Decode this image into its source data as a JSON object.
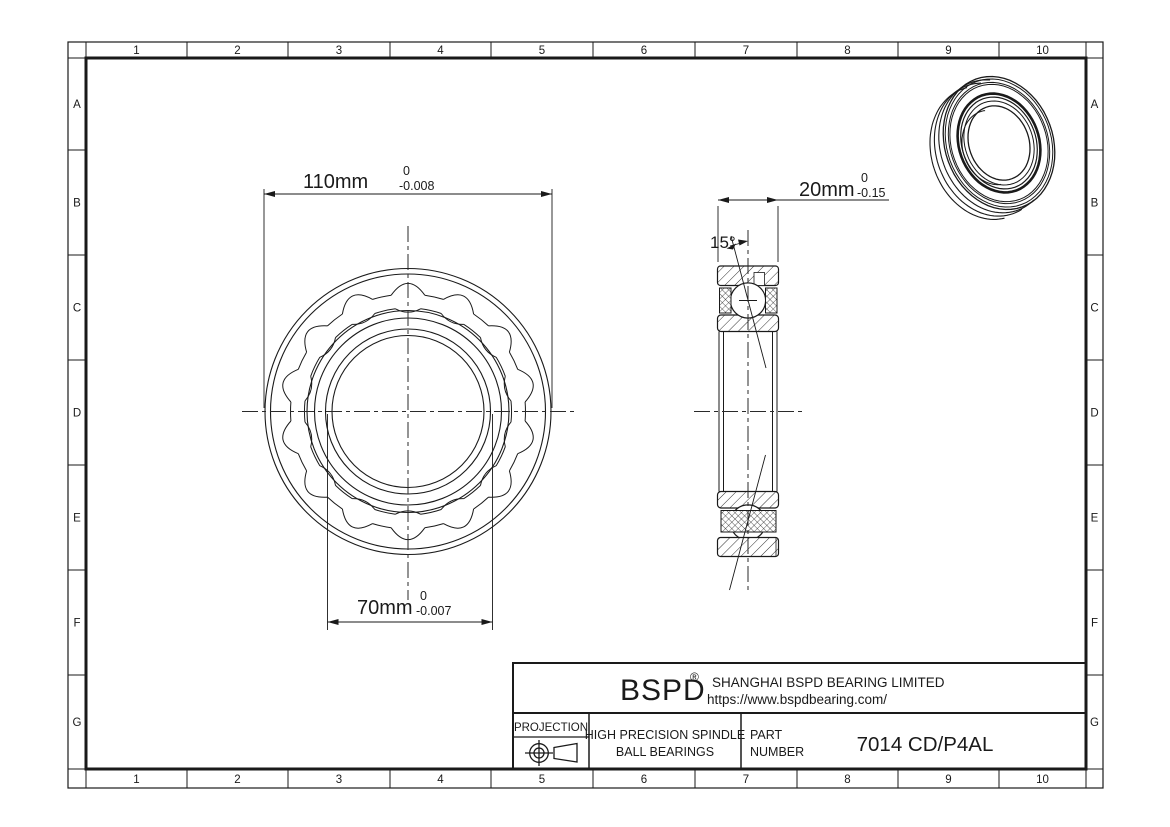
{
  "grid": {
    "columns": [
      "1",
      "2",
      "3",
      "4",
      "5",
      "6",
      "7",
      "8",
      "9",
      "10"
    ],
    "rows": [
      "A",
      "B",
      "C",
      "D",
      "E",
      "F",
      "G"
    ]
  },
  "views": {
    "front_view": {
      "outer_diameter": {
        "value": "110mm",
        "tol_upper": "0",
        "tol_lower": "-0.008"
      },
      "bore_diameter": {
        "value": "70mm",
        "tol_upper": "0",
        "tol_lower": "-0.007"
      }
    },
    "section_view": {
      "width": {
        "value": "20mm",
        "tol_upper": "0",
        "tol_lower": "-0.15"
      },
      "contact_angle": "15°"
    }
  },
  "title_block": {
    "logo": "BSPD",
    "registered_mark": "®",
    "company": "SHANGHAI BSPD BEARING LIMITED",
    "website": "https://www.bspdbearing.com/",
    "projection_label": "PROJECTION",
    "product_line1": "HIGH  PRECISION SPINDLE",
    "product_line2": "BALL BEARINGS",
    "part_label_line1": "PART",
    "part_label_line2": "NUMBER",
    "part_number": "7014 CD/P4AL"
  },
  "colors": {
    "line": "#1a1a1a",
    "background": "#ffffff"
  }
}
